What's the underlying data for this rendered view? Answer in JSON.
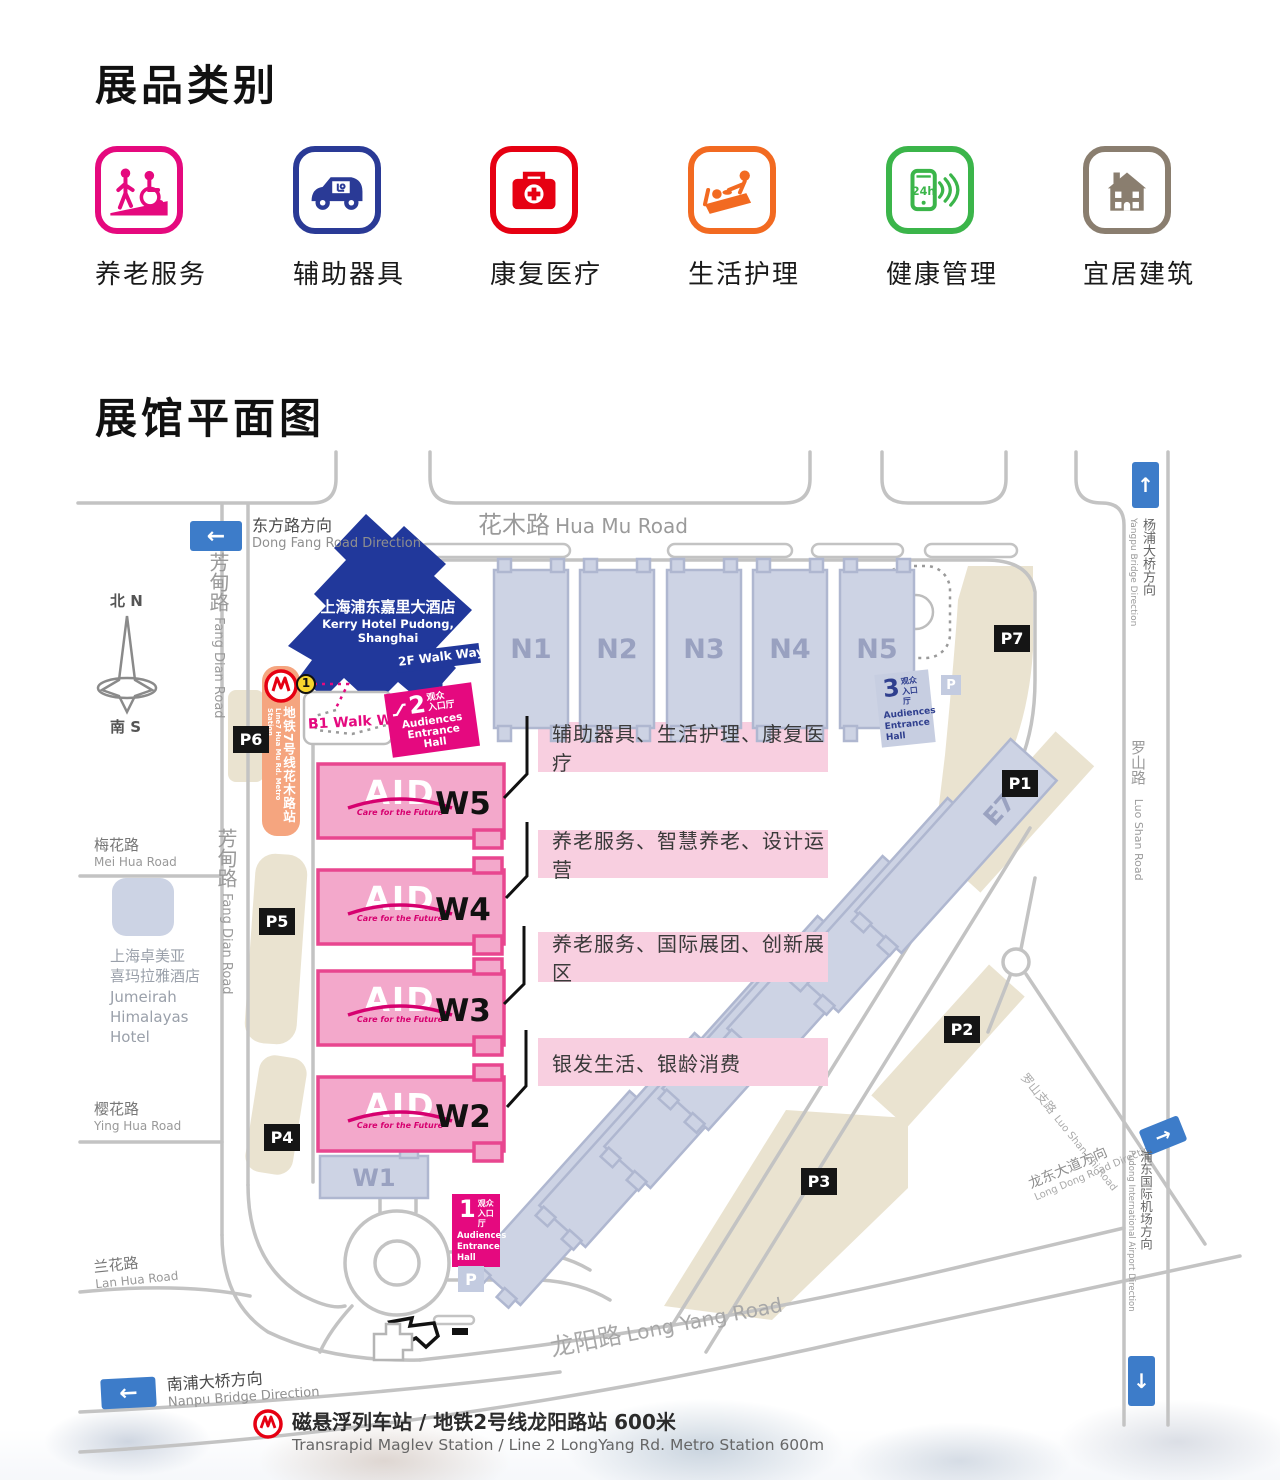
{
  "categories": {
    "title": "展品类别",
    "items": [
      {
        "label": "养老服务",
        "icon": "elder-service-icon",
        "color": "#E5097E"
      },
      {
        "label": "辅助器具",
        "icon": "assist-device-icon",
        "color": "#2A3A96"
      },
      {
        "label": "康复医疗",
        "icon": "rehab-medical-icon",
        "color": "#E60012"
      },
      {
        "label": "生活护理",
        "icon": "life-care-icon",
        "color": "#F26A21"
      },
      {
        "label": "健康管理",
        "icon": "health-manage-icon",
        "color": "#3BB54A",
        "badge": "24h"
      },
      {
        "label": "宜居建筑",
        "icon": "livable-building-icon",
        "color": "#8A7E6F"
      }
    ]
  },
  "map": {
    "title": "展馆平面图",
    "compass": {
      "north": "北 N",
      "south": "南 S"
    },
    "halls": {
      "north": [
        "N1",
        "N2",
        "N3",
        "N4",
        "N5"
      ],
      "west": [
        {
          "id": "W5"
        },
        {
          "id": "W4"
        },
        {
          "id": "W3"
        },
        {
          "id": "W2"
        }
      ],
      "west_logo": {
        "text": "AID",
        "tagline": "Care for the Future"
      },
      "w1": "W1",
      "east": [
        "E1",
        "E2",
        "E3",
        "E4",
        "E5",
        "E6",
        "E7"
      ]
    },
    "zones": [
      "辅助器具、生活护理、康复医疗",
      "养老服务、智慧养老、设计运营",
      "养老服务、国际展团、创新展区",
      "银发生活、银龄消费"
    ],
    "entrances": {
      "e2": {
        "num": "2",
        "cn1": "观众",
        "cn2": "入口厅",
        "en1": "Audiences",
        "en2": "Entrance Hall"
      },
      "e3": {
        "num": "3",
        "cn1": "观众",
        "cn2": "入口厅",
        "en1": "Audiences",
        "en2": "Entrance",
        "en3": "Hall"
      },
      "e1": {
        "num": "1",
        "cn1": "观众",
        "cn2": "入口厅",
        "en1": "Audiences",
        "en2": "Entrance",
        "en3": "Hall"
      }
    },
    "parking": {
      "labels": [
        "P1",
        "P2",
        "P3",
        "P4",
        "P5",
        "P6",
        "P7"
      ],
      "icon": "P"
    },
    "hotels": {
      "kerry": {
        "cn": "上海浦东嘉里大酒店",
        "en": "Kerry Hotel Pudong, Shanghai"
      },
      "jumeirah": {
        "lines": [
          "上海卓美亚",
          "喜玛拉雅酒店",
          "Jumeirah",
          "Himalayas",
          "Hotel"
        ]
      }
    },
    "walkways": {
      "b1": "B1 Walk Way",
      "f2": "2F Walk Way"
    },
    "metro": {
      "line7_station": {
        "cn": "地铁7号线花木路站",
        "en": "Line7 Hua Mu Rd. Metro Station",
        "badge": "1"
      },
      "maglev_note": {
        "cn": "磁悬浮列车站 / 地铁2号线龙阳路站 600米",
        "en": "Transrapid Maglev Station / Line 2 LongYang Rd. Metro Station   600m"
      }
    },
    "roads": {
      "huamu": {
        "cn": "花木路",
        "en": "Hua Mu Road"
      },
      "fangdian": {
        "cn": "芳甸路",
        "en": "Fang Dian Road"
      },
      "meihua": {
        "cn": "梅花路",
        "en": "Mei Hua Road"
      },
      "yinghua": {
        "cn": "樱花路",
        "en": "Ying Hua Road"
      },
      "lanhua": {
        "cn": "兰花路",
        "en": "Lan Hua Road"
      },
      "longyang": {
        "cn": "龙阳路",
        "en": "Long Yang Road"
      },
      "luoshan": {
        "cn": "罗山路",
        "en": "Luo Shan Road"
      },
      "luoshanzhi": {
        "cn": "罗山支路",
        "en": "Luo Shan Zhi Road"
      }
    },
    "directions": {
      "dongfang": {
        "cn": "东方路方向",
        "en": "Dong Fang Road Direction"
      },
      "nanpu": {
        "cn": "南浦大桥方向",
        "en": "Nanpu Bridge Direction"
      },
      "yangpu": {
        "cn": "杨浦大桥方向",
        "en": "Yangpu Bridge Direction"
      },
      "longdong": {
        "cn": "龙东大道方向",
        "en": "Long Dong Road Direction"
      },
      "airport": {
        "cn": "浦东国际机场方向",
        "en": "Pudong International Airport Direction"
      }
    }
  },
  "colors": {
    "magenta": "#E5097F",
    "hall_pink": "#F3A8CB",
    "pink_border": "#E8468F",
    "band_pink": "#F8CFE0",
    "periwinkle": "#CDD3E4",
    "navy": "#21389B",
    "tan": "#EAE3D0",
    "road_gray": "#C3C3C3",
    "sign_blue": "#3D7CC9",
    "metro_red": "#E60012",
    "metro_orange": "#F5A57F",
    "parking_black": "#151515"
  }
}
